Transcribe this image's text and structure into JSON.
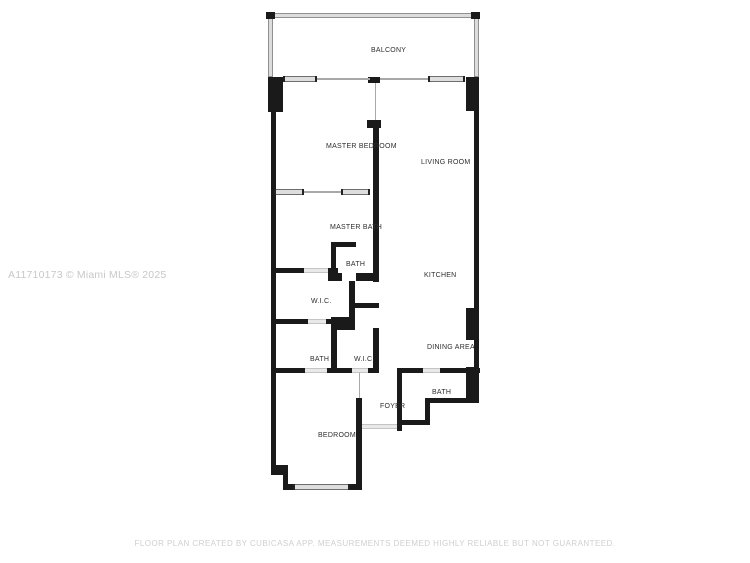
{
  "page": {
    "background": "#ffffff",
    "width": 750,
    "height": 563
  },
  "watermark": {
    "text": "A11710173 © Miami MLS® 2025"
  },
  "disclaimer": {
    "text": "FLOOR PLAN CREATED BY CUBICASA APP. MEASUREMENTS DEEMED HIGHLY RELIABLE BUT NOT GUARANTEED."
  },
  "colors": {
    "wall": "#1a1a1a",
    "railing_fill": "#dcdcdc",
    "railing_edge": "#909090",
    "slider_fill": "#dedede",
    "slider_edge": "#6e6e6e",
    "opening_fill": "#e9e9e9",
    "label": "#2e2e2e",
    "watermark": "#c8c8c8",
    "disclaimer": "#cfcfcf"
  },
  "floorplan": {
    "rooms": [
      {
        "id": "balcony",
        "label": "BALCONY",
        "cx": 371,
        "cy": 47
      },
      {
        "id": "master-bedroom",
        "label": "MASTER BEDROOM",
        "cx": 326,
        "cy": 143
      },
      {
        "id": "living-room",
        "label": "LIVING ROOM",
        "cx": 421,
        "cy": 159
      },
      {
        "id": "master-bath",
        "label": "MASTER BATH",
        "cx": 330,
        "cy": 224
      },
      {
        "id": "bath-1",
        "label": "BATH",
        "cx": 346,
        "cy": 261
      },
      {
        "id": "kitchen",
        "label": "KITCHEN",
        "cx": 424,
        "cy": 272
      },
      {
        "id": "wic-1",
        "label": "W.I.C.",
        "cx": 311,
        "cy": 298
      },
      {
        "id": "dining-area",
        "label": "DINING AREA",
        "cx": 427,
        "cy": 344
      },
      {
        "id": "bath-2",
        "label": "BATH",
        "cx": 310,
        "cy": 356
      },
      {
        "id": "wic-2",
        "label": "W.I.C.",
        "cx": 354,
        "cy": 356
      },
      {
        "id": "bath-3",
        "label": "BATH",
        "cx": 432,
        "cy": 389
      },
      {
        "id": "foyer",
        "label": "FOYER",
        "cx": 380,
        "cy": 403
      },
      {
        "id": "bedroom",
        "label": "BEDROOM",
        "cx": 318,
        "cy": 432
      }
    ],
    "walls": [
      [
        268,
        77,
        15,
        35
      ],
      [
        271,
        112,
        5,
        358
      ],
      [
        271,
        465,
        17,
        10
      ],
      [
        283,
        470,
        5,
        17
      ],
      [
        283,
        484,
        77,
        6
      ],
      [
        466,
        77,
        13,
        34
      ],
      [
        474,
        111,
        5,
        197
      ],
      [
        466,
        308,
        13,
        32
      ],
      [
        474,
        340,
        5,
        27
      ],
      [
        466,
        367,
        13,
        36
      ],
      [
        428,
        398,
        51,
        5
      ],
      [
        425,
        398,
        5,
        27
      ],
      [
        397,
        420,
        33,
        5
      ],
      [
        397,
        368,
        5,
        63
      ],
      [
        368,
        77,
        12,
        6
      ],
      [
        367,
        120,
        14,
        8
      ],
      [
        373,
        124,
        6,
        158
      ],
      [
        331,
        242,
        25,
        5
      ],
      [
        331,
        242,
        5,
        31
      ],
      [
        328,
        268,
        10,
        13
      ],
      [
        328,
        273,
        14,
        8
      ],
      [
        356,
        273,
        23,
        8
      ],
      [
        349,
        281,
        6,
        49
      ],
      [
        349,
        303,
        30,
        5
      ],
      [
        373,
        328,
        6,
        45
      ],
      [
        331,
        317,
        24,
        13
      ],
      [
        331,
        330,
        6,
        43
      ],
      [
        271,
        268,
        33,
        5
      ],
      [
        271,
        319,
        37,
        5
      ],
      [
        326,
        319,
        9,
        5
      ],
      [
        271,
        368,
        34,
        5
      ],
      [
        327,
        368,
        25,
        5
      ],
      [
        368,
        368,
        11,
        5
      ],
      [
        356,
        398,
        6,
        92
      ],
      [
        397,
        368,
        26,
        5
      ],
      [
        440,
        368,
        40,
        5
      ]
    ],
    "railings": [
      [
        268,
        13,
        211,
        5
      ],
      [
        268,
        13,
        5,
        64
      ],
      [
        474,
        13,
        5,
        64
      ]
    ],
    "posts": [
      [
        266,
        12,
        9,
        7
      ],
      [
        471,
        12,
        9,
        7
      ],
      [
        311,
        484,
        3,
        6
      ],
      [
        331,
        484,
        3,
        6
      ]
    ],
    "sliding_doors": [
      [
        283,
        76,
        34,
        6
      ],
      [
        428,
        76,
        37,
        6
      ],
      [
        274,
        189,
        30,
        6
      ],
      [
        341,
        189,
        29,
        6
      ]
    ],
    "door_openings": [
      [
        305,
        368,
        22,
        5
      ],
      [
        352,
        368,
        16,
        5
      ],
      [
        423,
        368,
        17,
        5
      ],
      [
        362,
        424,
        35,
        5
      ],
      [
        304,
        268,
        24,
        5
      ],
      [
        308,
        319,
        18,
        5
      ]
    ],
    "windows": [
      [
        293,
        484,
        57,
        6
      ]
    ],
    "thin_lines": [
      [
        317,
        78,
        53,
        2
      ],
      [
        380,
        78,
        48,
        2
      ],
      [
        375,
        83,
        1,
        37
      ],
      [
        304,
        191,
        37,
        2
      ],
      [
        359,
        373,
        1,
        25
      ]
    ]
  }
}
